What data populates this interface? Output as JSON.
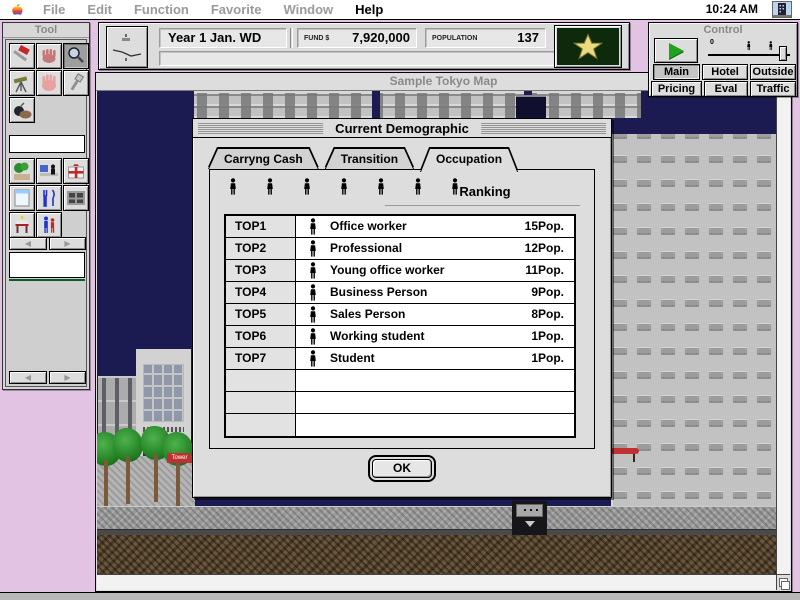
{
  "menu_bar": {
    "items": [
      {
        "label": "File",
        "enabled": false
      },
      {
        "label": "Edit",
        "enabled": false
      },
      {
        "label": "Function",
        "enabled": false
      },
      {
        "label": "Favorite",
        "enabled": false
      },
      {
        "label": "Window",
        "enabled": false
      },
      {
        "label": "Help",
        "enabled": true
      }
    ],
    "clock": "10:24 AM"
  },
  "toolbar": {
    "date_display": "Year 1 Jan. WD",
    "fund_label": "FUND $",
    "fund_value": "7,920,000",
    "population_label": "POPULATION",
    "population_value": "137",
    "message_bar": ""
  },
  "control_panel": {
    "title": "Control",
    "slider_min_label": "0",
    "buttons": [
      {
        "label": "Main",
        "active": true
      },
      {
        "label": "Hotel",
        "active": false
      },
      {
        "label": "Outside",
        "active": false
      },
      {
        "label": "Pricing",
        "active": false
      },
      {
        "label": "Eval",
        "active": false
      },
      {
        "label": "Traffic",
        "active": false
      }
    ]
  },
  "tool_palette": {
    "title": "Tool"
  },
  "map_window": {
    "title": "Sample Tokyo Map",
    "awning_label": "Tower"
  },
  "dialog": {
    "title": "Current Demographic",
    "tabs": [
      {
        "label": "Carryng Cash",
        "active": false
      },
      {
        "label": "Transition",
        "active": false
      },
      {
        "label": "Occupation",
        "active": true
      }
    ],
    "ranking_label": "Ranking",
    "table": {
      "rows": [
        {
          "rank": "TOP1",
          "occupation": "Office worker",
          "population": "15Pop."
        },
        {
          "rank": "TOP2",
          "occupation": "Professional",
          "population": "12Pop."
        },
        {
          "rank": "TOP3",
          "occupation": "Young office worker",
          "population": "11Pop."
        },
        {
          "rank": "TOP4",
          "occupation": "Business Person",
          "population": "9Pop."
        },
        {
          "rank": "TOP5",
          "occupation": "Sales Person",
          "population": "8Pop."
        },
        {
          "rank": "TOP6",
          "occupation": "Working student",
          "population": "1Pop."
        },
        {
          "rank": "TOP7",
          "occupation": "Student",
          "population": "1Pop."
        },
        {
          "rank": "",
          "occupation": "",
          "population": ""
        },
        {
          "rank": "",
          "occupation": "",
          "population": ""
        },
        {
          "rank": "",
          "occupation": "",
          "population": ""
        }
      ]
    },
    "ok_label": "OK"
  },
  "colors": {
    "desktop": "#E3C3E3",
    "sky": "#1B1B52",
    "badge_green": "#0D2A0D",
    "star_gold": "#EADC7E",
    "play_green": "#1FA31F",
    "accent_red": "#C03030"
  }
}
